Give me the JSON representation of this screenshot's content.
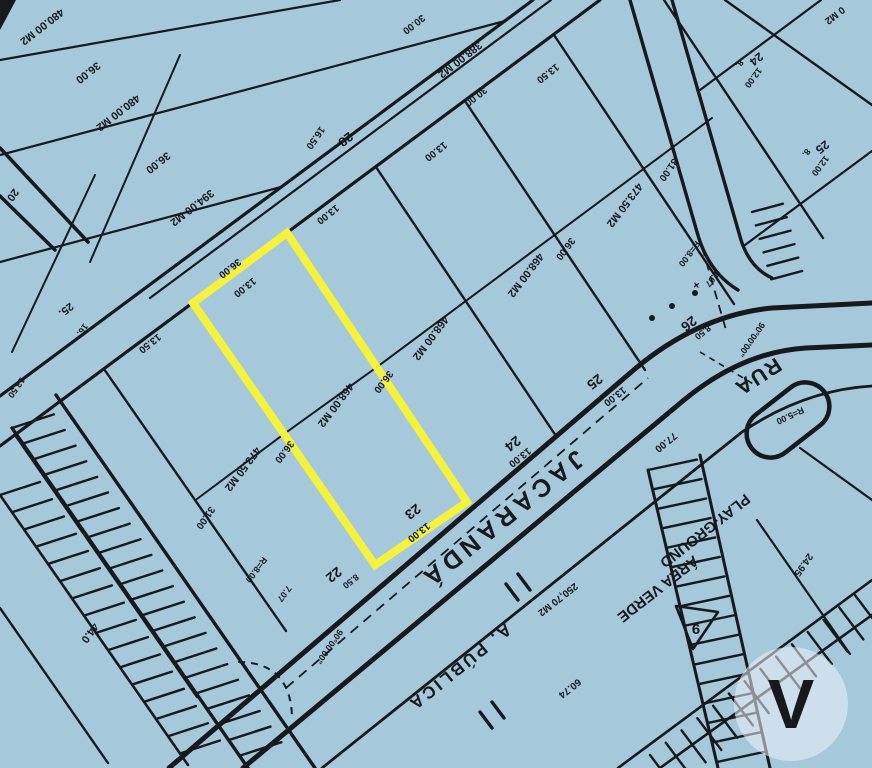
{
  "map": {
    "colors": {
      "background": "#a5c8db",
      "ink": "#17191c",
      "highlight": "#f4f23c",
      "watermark_circle": "rgba(236,242,246,0.55)",
      "watermark_letter": "rgba(255,255,255,0.92)"
    },
    "watermark": {
      "letter": "V",
      "x": 791,
      "y": 704,
      "r": 57
    },
    "highlight_lot": {
      "points": "287,233 193,303 375,565 467,502",
      "stroke_width": 8
    },
    "marker_triangle": {
      "path": "M676,606 L718,612 L693,649 Z"
    },
    "corner_wedge": "0,0 16,0 0,30",
    "lines": [
      [
        0,
        60,
        340,
        0,
        2.2
      ],
      [
        0,
        155,
        505,
        21,
        2.2
      ],
      [
        0,
        262,
        281,
        187,
        2.2
      ],
      [
        90,
        262,
        180,
        55,
        2
      ],
      [
        12,
        352,
        95,
        175,
        2
      ],
      [
        0,
        446,
        600,
        0,
        3.2
      ],
      [
        0,
        396,
        533,
        0,
        3.2
      ],
      [
        15,
        435,
        197,
        697,
        2.4
      ],
      [
        104,
        369,
        286,
        631,
        2.4
      ],
      [
        193,
        303,
        375,
        565,
        2
      ],
      [
        287,
        233,
        467,
        502,
        2
      ],
      [
        284,
        434,
        377,
        367,
        2
      ],
      [
        376,
        167,
        556,
        436,
        2.4
      ],
      [
        465,
        101,
        645,
        370,
        2.4
      ],
      [
        554,
        35,
        734,
        304,
        2.4
      ],
      [
        664,
        0,
        823,
        238,
        2.4
      ],
      [
        0,
        608,
        108,
        763,
        2.4
      ],
      [
        377,
        367,
        712,
        118,
        2
      ],
      [
        197,
        499,
        284,
        434,
        2
      ],
      [
        150,
        298,
        551,
        0,
        2.2
      ],
      [
        700,
        90,
        821,
        0,
        2.2
      ],
      [
        745,
        245,
        872,
        151,
        2.2
      ],
      [
        725,
        0,
        872,
        105,
        2.4
      ],
      [
        648,
        470,
        718,
        768,
        3
      ],
      [
        700,
        455,
        770,
        768,
        3
      ],
      [
        618,
        768,
        872,
        580,
        2.6
      ],
      [
        660,
        768,
        872,
        615,
        2.6
      ],
      [
        757,
        520,
        850,
        654,
        2.2
      ],
      [
        800,
        448,
        872,
        500,
        2.2
      ],
      [
        12,
        428,
        248,
        768,
        3.4
      ],
      [
        56,
        395,
        315,
        768,
        3.4
      ],
      [
        0,
        495,
        188,
        765,
        2.6
      ],
      [
        0,
        148,
        88,
        242,
        3.6
      ],
      [
        0,
        196,
        55,
        250,
        3.6
      ],
      [
        480,
        712,
        492,
        728,
        3.4
      ],
      [
        492,
        702,
        504,
        718,
        3.4
      ],
      [
        506,
        584,
        518,
        600,
        3.4
      ],
      [
        518,
        574,
        530,
        590,
        3.4
      ]
    ],
    "paths": [
      [
        "M169,768 L636,368 Q700,315 772,308 L872,303",
        5
      ],
      [
        "M243,768 L684,400 Q742,352 806,348 L872,345",
        5
      ],
      [
        "M322,768 L742,432 Q804,390 872,386",
        2.8
      ],
      [
        "M630,0 L697,232 Q708,272 738,290",
        3.4
      ],
      [
        "M672,0 L741,240 Q750,268 772,278",
        3.4
      ]
    ],
    "dashed": [
      [
        "M286,688 L648,378",
        1.8,
        "10 7"
      ],
      [
        "M648,60 L726,330",
        1.8,
        "9 6"
      ],
      [
        "M238,662 Q290,662 292,716",
        2,
        "7 6"
      ],
      [
        "M700,352 L755,385",
        1.6,
        "6 5"
      ]
    ],
    "rects": [
      {
        "cx": 788,
        "cy": 420,
        "w": 92,
        "h": 48,
        "rx": 24,
        "rot": -38,
        "sw": 4.5
      }
    ],
    "dots": [
      [
        652,
        318
      ],
      [
        672,
        306
      ],
      [
        695,
        293
      ]
    ],
    "hatches": [
      {
        "x1": 12,
        "y1": 428,
        "x2": 248,
        "y2": 768,
        "step": 19,
        "len": 44,
        "ang": -18
      },
      {
        "x1": 0,
        "y1": 495,
        "x2": 188,
        "y2": 765,
        "step": 21,
        "len": 42,
        "ang": -18
      },
      {
        "x1": 648,
        "y1": 470,
        "x2": 718,
        "y2": 768,
        "step": 20,
        "len": 50,
        "ang": -12
      },
      {
        "x1": 650,
        "y1": 755,
        "x2": 868,
        "y2": 585,
        "step": 20,
        "len": 40,
        "ang": 53
      },
      {
        "x1": 752,
        "y1": 212,
        "x2": 772,
        "y2": 282,
        "step": 14,
        "len": 32,
        "ang": -15
      }
    ],
    "labels": [
      {
        "n": "area-label",
        "t": "480.00 M2",
        "x": 40,
        "y": 24,
        "r": 142,
        "s": 11,
        "b": 1
      },
      {
        "n": "dimension-label",
        "t": "36.00",
        "x": 86,
        "y": 70,
        "r": 142,
        "s": 11,
        "b": 1
      },
      {
        "n": "area-label",
        "t": "480.00 M2",
        "x": 116,
        "y": 110,
        "r": 142,
        "s": 11,
        "b": 1
      },
      {
        "n": "dimension-label",
        "t": "36.00",
        "x": 156,
        "y": 160,
        "r": 142,
        "s": 11,
        "b": 1
      },
      {
        "n": "area-label",
        "t": "394.00 M2",
        "x": 190,
        "y": 205,
        "r": 142,
        "s": 11,
        "b": 1
      },
      {
        "n": "lot-number",
        "t": "20",
        "x": 10,
        "y": 193,
        "r": 125,
        "s": 11,
        "b": 1
      },
      {
        "n": "lot-number",
        "t": "25.",
        "x": 64,
        "y": 307,
        "r": 142,
        "s": 11,
        "b": 1
      },
      {
        "n": "dimension-label",
        "t": "16.",
        "x": 80,
        "y": 328,
        "r": 125,
        "s": 9,
        "b": 1
      },
      {
        "n": "dimension-label",
        "t": "13.50",
        "x": 14,
        "y": 386,
        "r": 125,
        "s": 9,
        "b": 1
      },
      {
        "n": "dimension-label",
        "t": "13.50",
        "x": 148,
        "y": 341,
        "r": 142,
        "s": 10,
        "b": 1
      },
      {
        "n": "dimension-label",
        "t": "30.00",
        "x": 412,
        "y": 22,
        "r": 142,
        "s": 10,
        "b": 1
      },
      {
        "n": "area-label",
        "t": "388.00 M2",
        "x": 458,
        "y": 57,
        "r": 142,
        "s": 11,
        "b": 1
      },
      {
        "n": "dimension-label",
        "t": "30.00",
        "x": 474,
        "y": 94,
        "r": 142,
        "s": 10,
        "b": 1
      },
      {
        "n": "dimension-label",
        "t": "13.50",
        "x": 546,
        "y": 71,
        "r": 142,
        "s": 10,
        "b": 1
      },
      {
        "n": "dimension-label",
        "t": "16.50",
        "x": 313,
        "y": 136,
        "r": 125,
        "s": 10,
        "b": 1
      },
      {
        "n": "lot-number",
        "t": "28",
        "x": 343,
        "y": 136,
        "r": 142,
        "s": 13,
        "b": 1
      },
      {
        "n": "dimension-label",
        "t": "13.00",
        "x": 434,
        "y": 149,
        "r": 142,
        "s": 10,
        "b": 1
      },
      {
        "n": "dimension-label",
        "t": "13.00",
        "x": 326,
        "y": 212,
        "r": 142,
        "s": 10,
        "b": 1
      },
      {
        "n": "dimension-label",
        "t": "36.00",
        "x": 228,
        "y": 266,
        "r": 142,
        "s": 10,
        "b": 1
      },
      {
        "n": "dimension-label",
        "t": "13.00",
        "x": 243,
        "y": 285,
        "r": 142,
        "s": 10,
        "b": 1
      },
      {
        "n": "area-label",
        "t": "468.00 M2",
        "x": 333,
        "y": 403,
        "r": 127,
        "s": 11,
        "b": 1
      },
      {
        "n": "dimension-label",
        "t": "36.00",
        "x": 381,
        "y": 380,
        "r": 127,
        "s": 10,
        "b": 1
      },
      {
        "n": "area-label",
        "t": "468.00 M2",
        "x": 428,
        "y": 336,
        "r": 127,
        "s": 11,
        "b": 1
      },
      {
        "n": "area-label",
        "t": "468.00 M2",
        "x": 523,
        "y": 273,
        "r": 127,
        "s": 11,
        "b": 1
      },
      {
        "n": "dimension-label",
        "t": "36.00",
        "x": 563,
        "y": 247,
        "r": 127,
        "s": 10,
        "b": 1
      },
      {
        "n": "area-label",
        "t": "473.50 M2",
        "x": 622,
        "y": 203,
        "r": 127,
        "s": 11,
        "b": 1
      },
      {
        "n": "dimension-label",
        "t": "31.00",
        "x": 666,
        "y": 168,
        "r": 125,
        "s": 10,
        "b": 1
      },
      {
        "n": "area-label",
        "t": "473.50 M2",
        "x": 240,
        "y": 467,
        "r": 127,
        "s": 11,
        "b": 1
      },
      {
        "n": "dimension-label",
        "t": "36.00",
        "x": 282,
        "y": 450,
        "r": 127,
        "s": 10,
        "b": 1
      },
      {
        "n": "dimension-label",
        "t": "31.00",
        "x": 203,
        "y": 516,
        "r": 125,
        "s": 10,
        "b": 1
      },
      {
        "n": "lot-number",
        "t": "22",
        "x": 331,
        "y": 571,
        "r": 142,
        "s": 14,
        "b": 1
      },
      {
        "n": "dimension-label",
        "t": "8.50",
        "x": 349,
        "y": 579,
        "r": 142,
        "s": 9,
        "b": 1
      },
      {
        "n": "dimension-label",
        "t": "R=8.00",
        "x": 254,
        "y": 568,
        "r": 127,
        "s": 9,
        "b": 1
      },
      {
        "n": "dimension-label",
        "t": "7.07",
        "x": 282,
        "y": 592,
        "r": 127,
        "s": 9,
        "b": 1
      },
      {
        "n": "lot-number",
        "t": "23",
        "x": 410,
        "y": 508,
        "r": 142,
        "s": 14,
        "b": 1
      },
      {
        "n": "dimension-label",
        "t": "13.00",
        "x": 417,
        "y": 530,
        "r": 142,
        "s": 10,
        "b": 1
      },
      {
        "n": "lot-number",
        "t": "24",
        "x": 510,
        "y": 440,
        "r": 142,
        "s": 14,
        "b": 1
      },
      {
        "n": "dimension-label",
        "t": "13.00",
        "x": 518,
        "y": 455,
        "r": 142,
        "s": 10,
        "b": 1
      },
      {
        "n": "lot-number",
        "t": "25",
        "x": 592,
        "y": 378,
        "r": 142,
        "s": 14,
        "b": 1
      },
      {
        "n": "dimension-label",
        "t": "13.00",
        "x": 613,
        "y": 394,
        "r": 142,
        "s": 10,
        "b": 1
      },
      {
        "n": "lot-number",
        "t": "26",
        "x": 686,
        "y": 320,
        "r": 142,
        "s": 14,
        "b": 1
      },
      {
        "n": "dimension-label",
        "t": "8.50",
        "x": 701,
        "y": 330,
        "r": 142,
        "s": 9,
        "b": 1
      },
      {
        "n": "dimension-label",
        "t": "7.07",
        "x": 710,
        "y": 277,
        "r": 127,
        "s": 9,
        "b": 1
      },
      {
        "n": "dimension-label",
        "t": "R=8.00",
        "x": 687,
        "y": 252,
        "r": 127,
        "s": 9,
        "b": 1
      },
      {
        "n": "survey-cross",
        "t": "+",
        "x": 694,
        "y": 282,
        "r": 142,
        "s": 12,
        "b": 1
      },
      {
        "n": "lot-number",
        "t": "24",
        "x": 754,
        "y": 56,
        "r": 142,
        "s": 12,
        "b": 1
      },
      {
        "n": "dimension-label",
        "t": "8.",
        "x": 737,
        "y": 62,
        "r": 127,
        "s": 9,
        "b": 1
      },
      {
        "n": "dimension-label",
        "t": "12.00",
        "x": 751,
        "y": 76,
        "r": 127,
        "s": 9,
        "b": 1
      },
      {
        "n": "lot-number",
        "t": "25",
        "x": 820,
        "y": 144,
        "r": 142,
        "s": 12,
        "b": 1
      },
      {
        "n": "dimension-label",
        "t": "8.",
        "x": 804,
        "y": 151,
        "r": 127,
        "s": 9,
        "b": 1
      },
      {
        "n": "dimension-label",
        "t": "12.00",
        "x": 818,
        "y": 164,
        "r": 127,
        "s": 9,
        "b": 1
      },
      {
        "n": "area-label",
        "t": "0 M2",
        "x": 833,
        "y": 13,
        "r": 142,
        "s": 10,
        "b": 1
      },
      {
        "n": "street-name-jacaranda",
        "t": "JACARANDÁ",
        "x": 497,
        "y": 513,
        "r": 141,
        "s": 25,
        "b": 1,
        "ls": 5
      },
      {
        "n": "street-label-publica",
        "t": "A. PÚBLICA",
        "x": 456,
        "y": 663,
        "r": 141,
        "s": 17,
        "b": 1,
        "ls": 3
      },
      {
        "n": "street-name-rua",
        "t": "RUA",
        "x": 754,
        "y": 371,
        "r": 147,
        "s": 21,
        "b": 1,
        "ls": 2
      },
      {
        "n": "angle-label",
        "t": "90°00'00\"",
        "x": 327,
        "y": 645,
        "r": 125,
        "s": 9,
        "b": 1
      },
      {
        "n": "angle-label",
        "t": "90°00'00\"",
        "x": 749,
        "y": 338,
        "r": 125,
        "s": 9,
        "b": 1
      },
      {
        "n": "dimension-label",
        "t": "R=5.00",
        "x": 789,
        "y": 413,
        "r": 155,
        "s": 9,
        "b": 1
      },
      {
        "n": "dimension-label",
        "t": "77.00",
        "x": 664,
        "y": 440,
        "r": 141,
        "s": 10,
        "b": 1
      },
      {
        "n": "green-area-label",
        "t": "ÁREA VERDE",
        "x": 655,
        "y": 585,
        "r": 142,
        "s": 15,
        "b": 1
      },
      {
        "n": "green-area-label",
        "t": "PLAY-GROUND",
        "x": 702,
        "y": 527,
        "r": 142,
        "s": 15,
        "b": 1
      },
      {
        "n": "area-label",
        "t": "250,70 M2",
        "x": 556,
        "y": 597,
        "r": 142,
        "s": 10,
        "b": 1
      },
      {
        "n": "marker-number",
        "t": "9",
        "x": 696,
        "y": 624,
        "r": 180,
        "s": 15,
        "b": 1
      },
      {
        "n": "dimension-label",
        "t": "60.74",
        "x": 568,
        "y": 686,
        "r": 142,
        "s": 10,
        "b": 1
      },
      {
        "n": "dimension-label",
        "t": "24.95",
        "x": 801,
        "y": 563,
        "r": 125,
        "s": 10,
        "b": 1
      },
      {
        "n": "dimension-label",
        "t": "44.0",
        "x": 87,
        "y": 631,
        "r": 125,
        "s": 11,
        "b": 1
      }
    ]
  }
}
